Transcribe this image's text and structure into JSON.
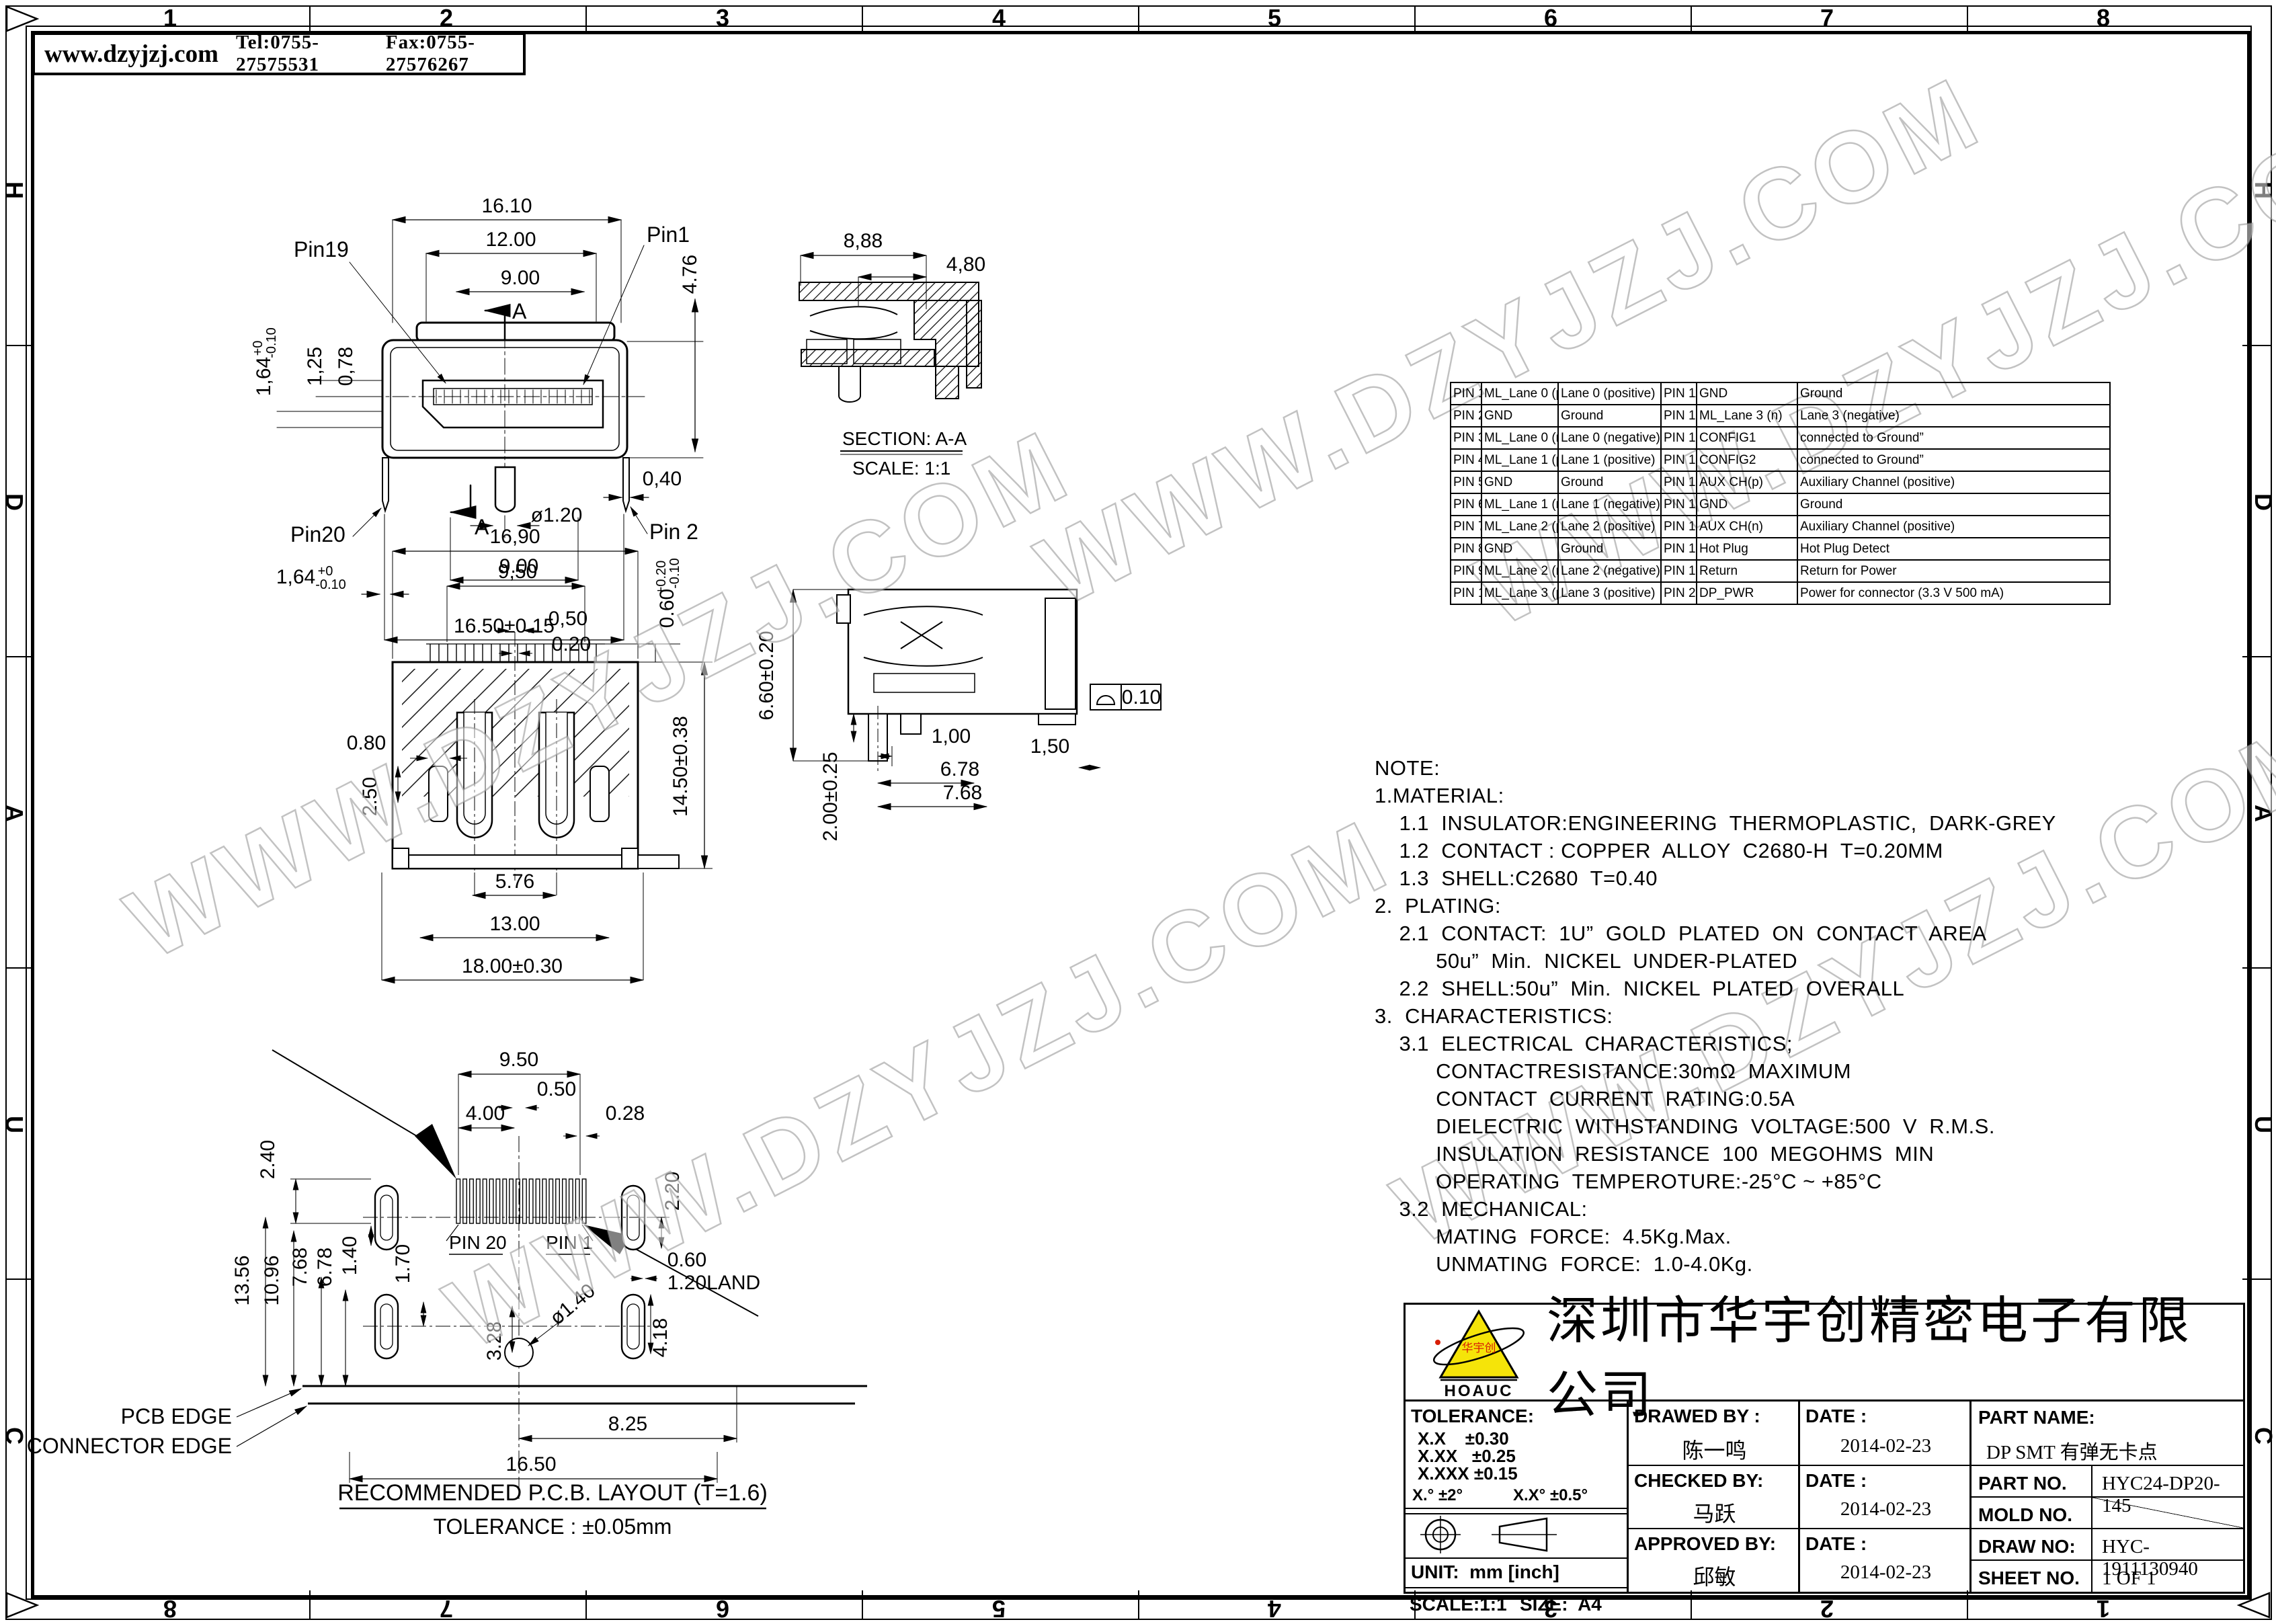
{
  "header": {
    "website": "www.dzyjzj.com",
    "tel": "Tel:0755-27575531",
    "fax": "Fax:0755-27576267"
  },
  "border": {
    "top": [
      "1",
      "2",
      "3",
      "4",
      "5",
      "6",
      "7",
      "8"
    ],
    "bottom": [
      "8",
      "7",
      "6",
      "5",
      "4",
      "3",
      "2",
      "1"
    ],
    "left": [
      "H",
      "D",
      "A",
      "U",
      "C"
    ],
    "right": [
      "H",
      "D",
      "A",
      "U",
      "C"
    ]
  },
  "watermark": "WWW.DZYJZJ.COM",
  "front_view": {
    "labels": {
      "pin19": "Pin19",
      "pin1": "Pin1",
      "pin20": "Pin20",
      "pin2": "Pin 2",
      "a1": "A",
      "a2": "A"
    },
    "dims": {
      "d1": "16.10",
      "d2": "12.00",
      "d3": "9.00",
      "d4": "4.76",
      "d5": "1,64",
      "d5a": "+0",
      "d5b": "-0.10",
      "d6": "1,25",
      "d7": "0,78",
      "d8": "0,40",
      "d9": "ø1.20",
      "d10": "9.00",
      "d11": "16.50±0.15",
      "d12": "1,64",
      "d12a": "+0",
      "d12b": "-0.10"
    }
  },
  "section_view": {
    "dims": {
      "d1": "8,88",
      "d2": "4,80"
    },
    "caption": "SECTION: A-A",
    "scale": "SCALE: 1:1"
  },
  "rear_view": {
    "dims": {
      "d1": "16,90",
      "d2": "9,50",
      "d3": "0,50",
      "d4": "0.20",
      "d5": "0.60",
      "d5a": "+0.20",
      "d5b": "-0.10",
      "d6": "0.80",
      "d7": "2.50",
      "d8": "14.50±0.38",
      "d9": "5.76",
      "d10": "13.00",
      "d11": "18.00±0.30"
    }
  },
  "side_view": {
    "dims": {
      "d1": "6.60±0.20",
      "d2": "2.00±0.25",
      "d3": "1,00",
      "d4": "1,50",
      "d5": "6.78",
      "d6": "7.68",
      "flat": "0.10"
    }
  },
  "pcb_view": {
    "dims": {
      "d950": "9.50",
      "d050": "0.50",
      "d400": "4.00",
      "d028": "0.28",
      "d240": "2.40",
      "d220": "2.20",
      "d1356": "13.56",
      "d1096": "10.96",
      "d768": "7.68",
      "d678": "6.78",
      "d140": "1.40",
      "d170": "1.70",
      "dia": "ø1.40",
      "d060": "0.60",
      "dland": "1.20LAND",
      "d328": "3.28",
      "d418": "4.18",
      "d825": "8.25",
      "d1650": "16.50"
    },
    "labels": {
      "pin20": "PIN 20",
      "pin1": "PIN 1",
      "pcb": "PCB EDGE",
      "conn": "CONNECTOR EDGE"
    },
    "caption": "RECOMMENDED P.C.B. LAYOUT (T=1.6)",
    "tolerance": "TOLERANCE : ±0.05mm"
  },
  "pin_table": {
    "rows": [
      [
        "PIN 1",
        "ML_Lane 0 (p)",
        "Lane 0 (positive)",
        "PIN 11",
        "GND",
        "Ground"
      ],
      [
        "PIN 2",
        "GND",
        "Ground",
        "PIN 12",
        "ML_Lane 3 (n)",
        "Lane 3 (negative)"
      ],
      [
        "PIN 3",
        "ML_Lane 0 (n)",
        "Lane 0 (negative)",
        "PIN 13",
        "CONFIG1",
        "connected to Ground”"
      ],
      [
        "PIN 4",
        "ML_Lane 1 (p)",
        "Lane 1 (positive)",
        "PIN 14",
        "CONFIG2",
        "connected to Ground”"
      ],
      [
        "PIN 5",
        "GND",
        "Ground",
        "PIN 15",
        "AUX CH(p)",
        "Auxiliary Channel (positive)"
      ],
      [
        "PIN 6",
        "ML_Lane 1 (n)",
        "Lane 1 (negative)",
        "PIN 16",
        "GND",
        "Ground"
      ],
      [
        "PIN 7",
        "ML_Lane 2 (p)",
        "Lane 2 (positive)",
        "PIN 17",
        "AUX CH(n)",
        "Auxiliary Channel (positive)"
      ],
      [
        "PIN 8",
        "GND",
        "Ground",
        "PIN 18",
        "Hot Plug",
        "Hot Plug Detect"
      ],
      [
        "PIN 9",
        "ML_Lane 2 (n)",
        "Lane 2 (negative)",
        "PIN 19",
        "Return",
        "Return for Power"
      ],
      [
        "PIN 10",
        "ML_Lane 3 (p)",
        "Lane 3 (positive)",
        "PIN 20",
        "DP_PWR",
        "Power for connector (3.3 V 500 mA)"
      ]
    ]
  },
  "notes": [
    "NOTE:",
    "1.MATERIAL:",
    "    1.1  INSULATOR:ENGINEERING  THERMOPLASTIC,  DARK-GREY",
    "    1.2  CONTACT : COPPER  ALLOY  C2680-H  T=0.20MM",
    "    1.3  SHELL:C2680  T=0.40",
    "2.  PLATING:",
    "    2.1  CONTACT:  1U”  GOLD  PLATED  ON  CONTACT  AREA",
    "          50u”  Min.  NICKEL  UNDER-PLATED",
    "    2.2  SHELL:50u”  Min.  NICKEL  PLATED  OVERALL",
    "3.  CHARACTERISTICS:",
    "    3.1  ELECTRICAL  CHARACTERISTICS;",
    "          CONTACTRESISTANCE:30mΩ  MAXIMUM",
    "          CONTACT  CURRENT  RATING:0.5A",
    "          DIELECTRIC  WITHSTANDING  VOLTAGE:500  V  R.M.S.",
    "          INSULATION  RESISTANCE  100  MEGOHMS  MIN",
    "          OPERATING  TEMPEROTURE:-25°C ~ +85°C",
    "    3.2  MECHANICAL:",
    "          MATING  FORCE:  4.5Kg.Max.",
    "          UNMATING  FORCE:  1.0-4.0Kg."
  ],
  "title_block": {
    "company": "深圳市华宇创精密电子有限公司",
    "logo_text": "HOAUC",
    "logo_cn": "华宇创",
    "tolerance_title": "TOLERANCE:",
    "tol1": "X.X    ±0.30",
    "tol2": "X.XX   ±0.25",
    "tol3": "X.XXX ±0.15",
    "ang1": "X.°  ±2°",
    "ang2": "X.X°  ±0.5°",
    "unit": "UNIT:  mm [inch]",
    "scale": "SCALE:1:1",
    "size": "SIZE:  A4",
    "drawed_label": "DRAWED BY :",
    "drawed_name": "陈一鸣",
    "checked_label": "CHECKED BY:",
    "checked_name": "马跃",
    "approved_label": "APPROVED BY:",
    "approved_name": "邱敏",
    "date_label": "DATE :",
    "date1": "2014-02-23",
    "date2": "2014-02-23",
    "date3": "2014-02-23",
    "part_name_label": "PART NAME:",
    "part_name": "DP SMT 有弹无卡点",
    "part_no_label": "PART NO.",
    "part_no": "HYC24-DP20-145",
    "mold_no_label": "MOLD NO.",
    "draw_no_label": "DRAW NO:",
    "draw_no": "HYC-1911130940",
    "sheet_no_label": "SHEET NO.",
    "sheet_no": "1 OF 1"
  }
}
